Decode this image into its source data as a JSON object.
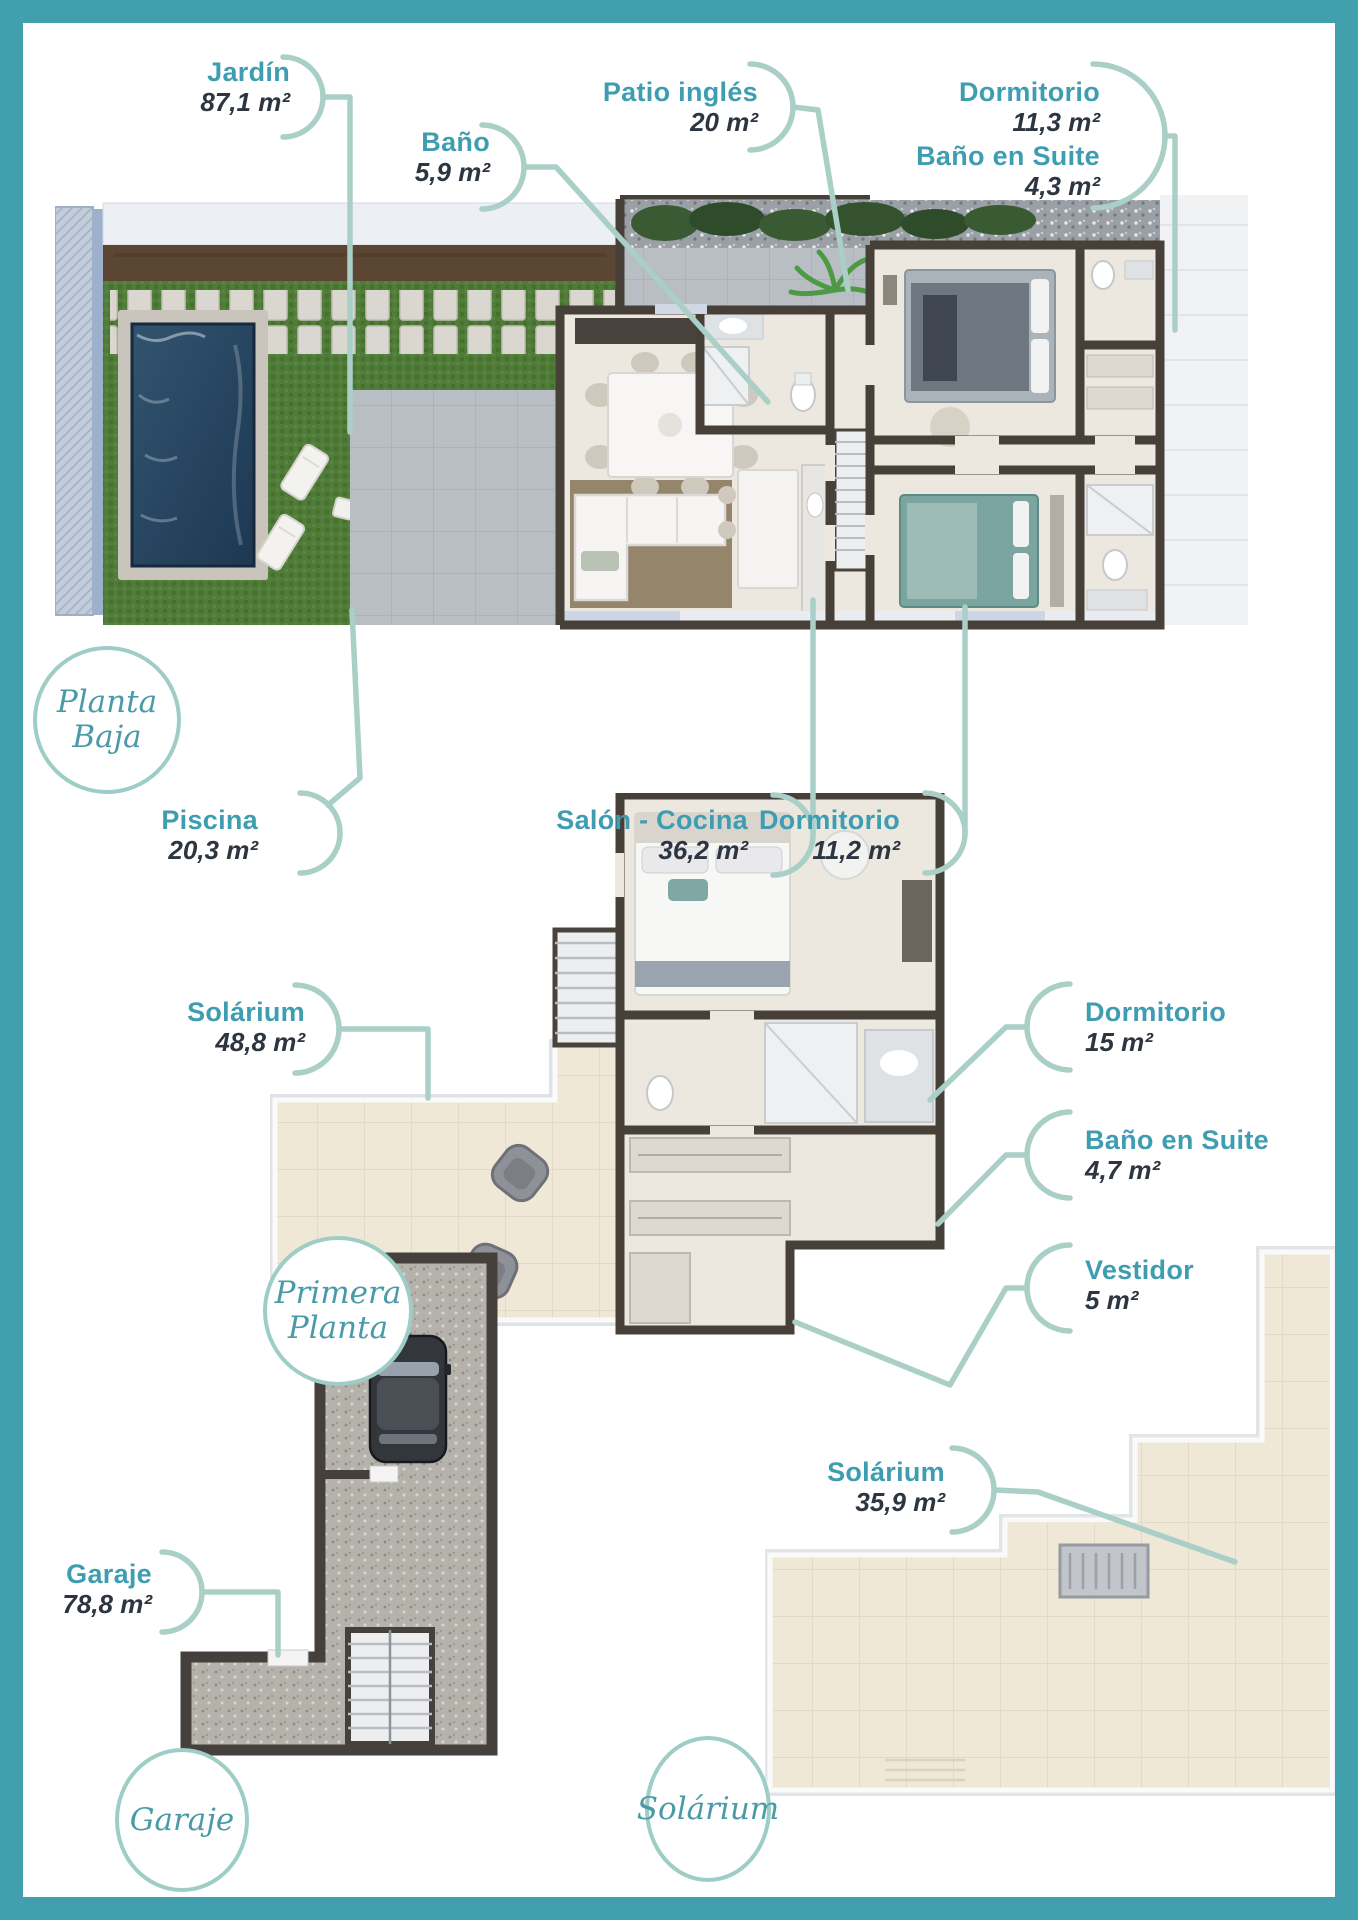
{
  "document": {
    "type": "floor-plan-brochure",
    "language": "es",
    "frame_color": "#429fae",
    "colors": {
      "room_name": "#3f9db2",
      "area_text": "#2d3540",
      "callout_line": "#a9cfc7",
      "badge_border": "#9ecdc5",
      "badge_text": "#4b9aa8",
      "pool_water": "#2b4a66",
      "grass": "#507c3a",
      "solarium_tile": "#efe8d6"
    }
  },
  "labels": {
    "jardin": {
      "name": "Jardín",
      "area": "87,1 m²"
    },
    "bano": {
      "name": "Baño",
      "area": "5,9 m²"
    },
    "patio_ingles": {
      "name": "Patio inglés",
      "area": "20 m²"
    },
    "dormitorio1": {
      "name": "Dormitorio",
      "area": "11,3 m²"
    },
    "bano_suite1": {
      "name": "Baño en Suite",
      "area": "4,3 m²"
    },
    "piscina": {
      "name": "Piscina",
      "area": "20,3 m²"
    },
    "salon_cocina": {
      "name": "Salón - Cocina",
      "area": "36,2 m²"
    },
    "dormitorio2": {
      "name": "Dormitorio",
      "area": "11,2 m²"
    },
    "solarium1": {
      "name": "Solárium",
      "area": "48,8 m²"
    },
    "dormitorio3": {
      "name": "Dormitorio",
      "area": "15 m²"
    },
    "bano_suite2": {
      "name": "Baño en Suite",
      "area": "4,7 m²"
    },
    "vestidor": {
      "name": "Vestidor",
      "area": "5 m²"
    },
    "garaje": {
      "name": "Garaje",
      "area": "78,8 m²"
    },
    "solarium2": {
      "name": "Solárium",
      "area": "35,9 m²"
    }
  },
  "badges": {
    "planta_baja": {
      "line1": "Planta",
      "line2": "Baja"
    },
    "primera_planta": {
      "line1": "Primera",
      "line2": "Planta"
    },
    "garaje": {
      "line1": "Garaje",
      "line2": ""
    },
    "solarium": {
      "line1": "Solárium",
      "line2": ""
    }
  }
}
